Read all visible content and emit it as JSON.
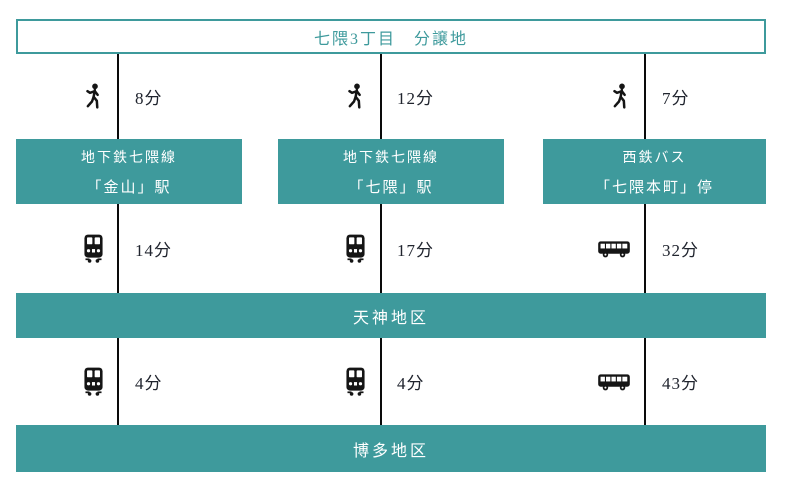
{
  "title": "七隈3丁目　分譲地",
  "colors": {
    "teal": "#3E9A9C",
    "connector_line": "#0A0A0A",
    "time_text": "#20242E",
    "background": "#FFFFFF",
    "station_text": "#FFFFFF"
  },
  "columns": [
    {
      "walk_time": "8分",
      "station_line": "地下鉄七隈線",
      "station_name": "「金山」駅",
      "tenjin_mode": "train",
      "tenjin_time": "14分",
      "hakata_mode": "train",
      "hakata_time": "4分"
    },
    {
      "walk_time": "12分",
      "station_line": "地下鉄七隈線",
      "station_name": "「七隈」駅",
      "tenjin_mode": "train",
      "tenjin_time": "17分",
      "hakata_mode": "train",
      "hakata_time": "4分"
    },
    {
      "walk_time": "7分",
      "station_line": "西鉄バス",
      "station_name": "「七隈本町」停",
      "tenjin_mode": "bus",
      "tenjin_time": "32分",
      "hakata_mode": "bus",
      "hakata_time": "43分"
    }
  ],
  "destinations": {
    "tenjin": "天神地区",
    "hakata": "博多地区"
  }
}
